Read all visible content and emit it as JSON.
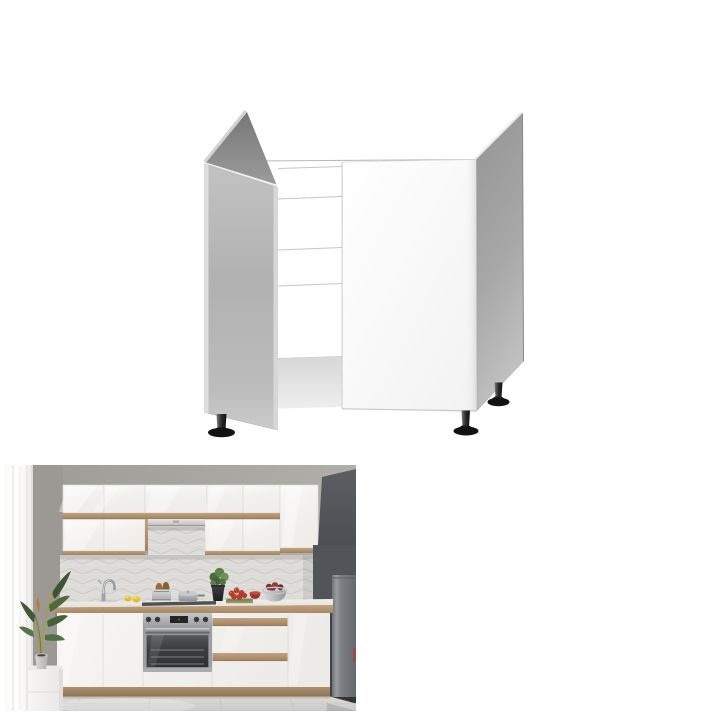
{
  "page": {
    "background_color": "#ffffff",
    "description": "Product listing composite image: 3D render of sink base cabinet above kitchen lifestyle photo"
  },
  "product_render": {
    "alt": "White sink base cabinet 3D render with open left door, open top, interior rails and three black adjustable feet",
    "colors": {
      "body_white": "#fcfcfc",
      "door_gray": "#b6b6b6",
      "side_panel_gray": "#a0a0a0",
      "inner_panel_dark": "#808080",
      "rail_line": "#c5c5c5",
      "feet_black": "#161616"
    }
  },
  "lifestyle_photo": {
    "alt": "Modern kitchen with white gloss cabinets, wood recessed handle strips, slim hood, built-in stainless oven, drawer stack, dark gray tall fridge column, tiled backsplash, potted plants, lemons, tomatoes and bowls on the worktop",
    "scene_objects": [
      "window light with curtain",
      "floor plant in gray pot on white pedestal",
      "upper gloss cabinets with wood strip",
      "slim range hood",
      "chevron tile backsplash",
      "chrome faucet",
      "lemons",
      "toaster with bread",
      "saucepan",
      "herb pot",
      "tomatoes on cutting board",
      "red bowl",
      "metal fruit bowl",
      "wood edge countertop with hob",
      "built-in oven",
      "drawer cabinet",
      "dark gray fridge column",
      "wood plinth",
      "tiled floor"
    ],
    "colors": {
      "wall": "#a7a39f",
      "cabinet_white": "#f3f2ef",
      "wood_trim": "#b29272",
      "backsplash_tile": "#dedcd8",
      "dark_unit": "#53565a",
      "fridge": "#777a7e",
      "floor": "#d5d3cf",
      "plant_green": "#4e6b3e",
      "lemon_yellow": "#e8cc3a",
      "tomato_red": "#c2392f",
      "steel": "#a9acaf"
    }
  },
  "css_vars": {
    "bg": "#ffffff",
    "cab-white": "#f3f2ef",
    "wood": "#b29272",
    "wall": "#a7a39f",
    "wall-dark": "#9c9893",
    "tile": "#dedcd8",
    "dark-unit": "#53565a",
    "fridge": "#777a7e",
    "floor": "#d5d3cf",
    "door-gray": "#b6b6b6",
    "panel-gray": "#a0a0a0",
    "feet": "#161616",
    "steel": "#a9acaf"
  }
}
